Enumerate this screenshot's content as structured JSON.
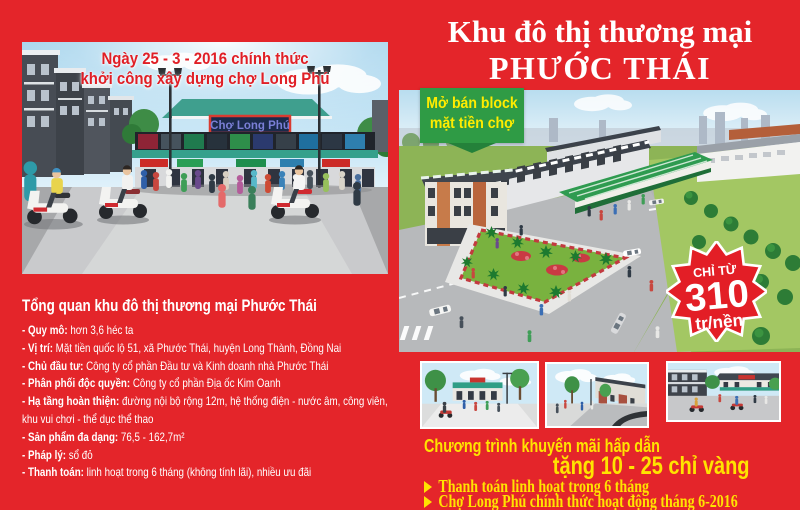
{
  "colors": {
    "background_red": "#e4252a",
    "badge_green": "#2f9b45",
    "accent_yellow": "#ffe300",
    "caption_red": "#e01f26",
    "starburst_red": "#e31e26"
  },
  "left": {
    "photo": {
      "caption_line1": "Ngày 25 - 3 - 2016 chính thức",
      "caption_line2": "khởi công xây dựng chợ Long Phú",
      "market_sign": "Chợ Long Phú"
    },
    "overview": {
      "heading": "Tổng quan khu đô thị thương mại Phước Thái",
      "items": [
        {
          "label": "- Quy mô:",
          "text": " hơn 3,6 héc ta"
        },
        {
          "label": "- Vị trí:",
          "text": " Mặt tiền quốc lộ 51, xã Phước Thái, huyện Long Thành, Đồng Nai"
        },
        {
          "label": "- Chủ đầu tư:",
          "text": " Công ty cổ phần Đầu tư và Kinh doanh nhà Phước Thái"
        },
        {
          "label": "- Phân phối độc quyền:",
          "text": " Công ty cổ phần Địa ốc Kim Oanh"
        },
        {
          "label": "- Hạ tầng hoàn thiện:",
          "text": " đường nội bộ rộng 12m, hệ thống điện - nước âm, công viên, khu vui chơi - thể dục thể thao"
        },
        {
          "label": "- Sản phẩm đa dạng:",
          "text": " 76,5 - 162,7m²"
        },
        {
          "label": "- Pháp lý:",
          "text": " sổ đỏ"
        },
        {
          "label": "- Thanh toán:",
          "text": " linh hoạt trong 6 tháng (không tính lãi), nhiều ưu đãi"
        }
      ]
    }
  },
  "right": {
    "title_line1": "Khu đô thị thương mại",
    "title_line2": "PHƯỚC THÁI",
    "ribbon": {
      "line1": "Mở bán block",
      "line2": "mặt tiền chợ"
    },
    "price_badge": {
      "top": "CHỈ TỪ",
      "value": "310",
      "unit": "tr/nền"
    },
    "promo": {
      "line1": "Chương trình khuyến mãi hấp dẫn",
      "line2": "tặng 10 - 25 chỉ vàng",
      "bullets": [
        "Thanh toán linh hoạt trong 6 tháng",
        "Chợ Long Phú chính thức hoạt động tháng 6-2016"
      ]
    }
  }
}
